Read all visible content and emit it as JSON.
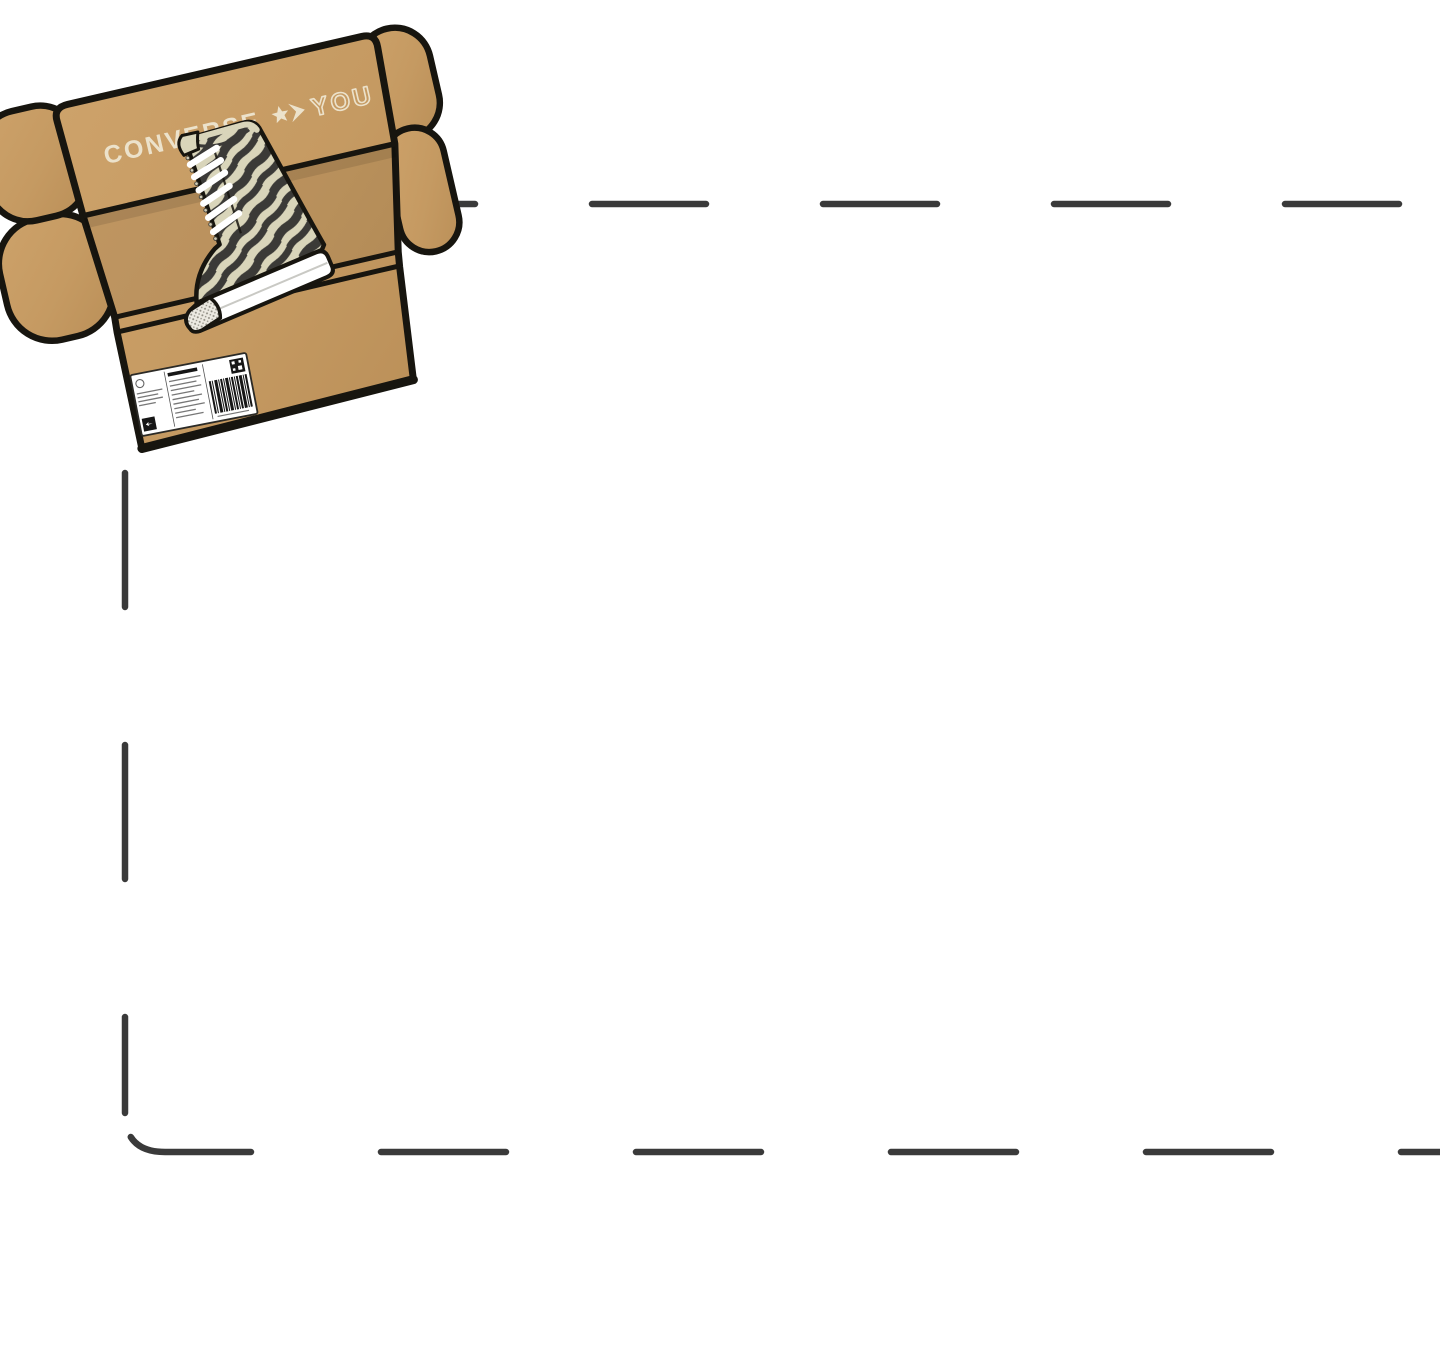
{
  "page": {
    "background_color": "#ffffff"
  },
  "dashed_frame": {
    "color": "#3a3a3a"
  },
  "shoebox": {
    "brand_label": "CONVERSE",
    "you_label": "YOU",
    "colors": {
      "cardboard": "#c59a62",
      "cardboard_light": "#cda26a",
      "cardboard_dark": "#ba8f58",
      "outline": "#17150f",
      "logo_cream": "#ece2cb",
      "zebra_dark": "#3b3a37",
      "zebra_cream": "#d9d5ba",
      "sole_white": "#ffffff",
      "label_white": "#ffffff",
      "label_ink": "#161616"
    }
  }
}
